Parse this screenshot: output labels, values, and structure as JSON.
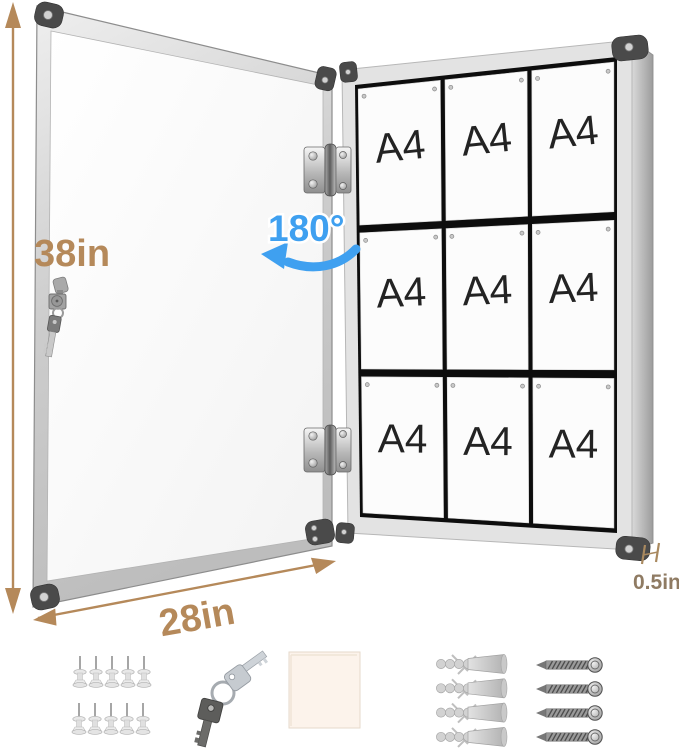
{
  "annotations": {
    "height_label": "38in",
    "width_label": "28in",
    "depth_label": "0.5in",
    "swing_angle_label": "180°"
  },
  "board": {
    "rows": 3,
    "cols": 3,
    "sheet_label": "A4"
  },
  "accessories": {
    "push_pins": {
      "name": "push pins",
      "count": 10
    },
    "keys": {
      "name": "keys",
      "count": 2
    },
    "adhesive_pad": {
      "name": "adhesive pad",
      "count": 1
    },
    "wall_anchors": {
      "name": "wall anchors",
      "count": 4
    },
    "screws": {
      "name": "screws",
      "count": 4
    }
  },
  "colors": {
    "dimension_text": "#b5895a",
    "depth_text": "#8f7b63",
    "swing_blue": "#3fa0f0",
    "frame_silver": "#d7d7d7",
    "board_backing": "#0d0d0d",
    "sheet_white": "#fcfcfc"
  }
}
